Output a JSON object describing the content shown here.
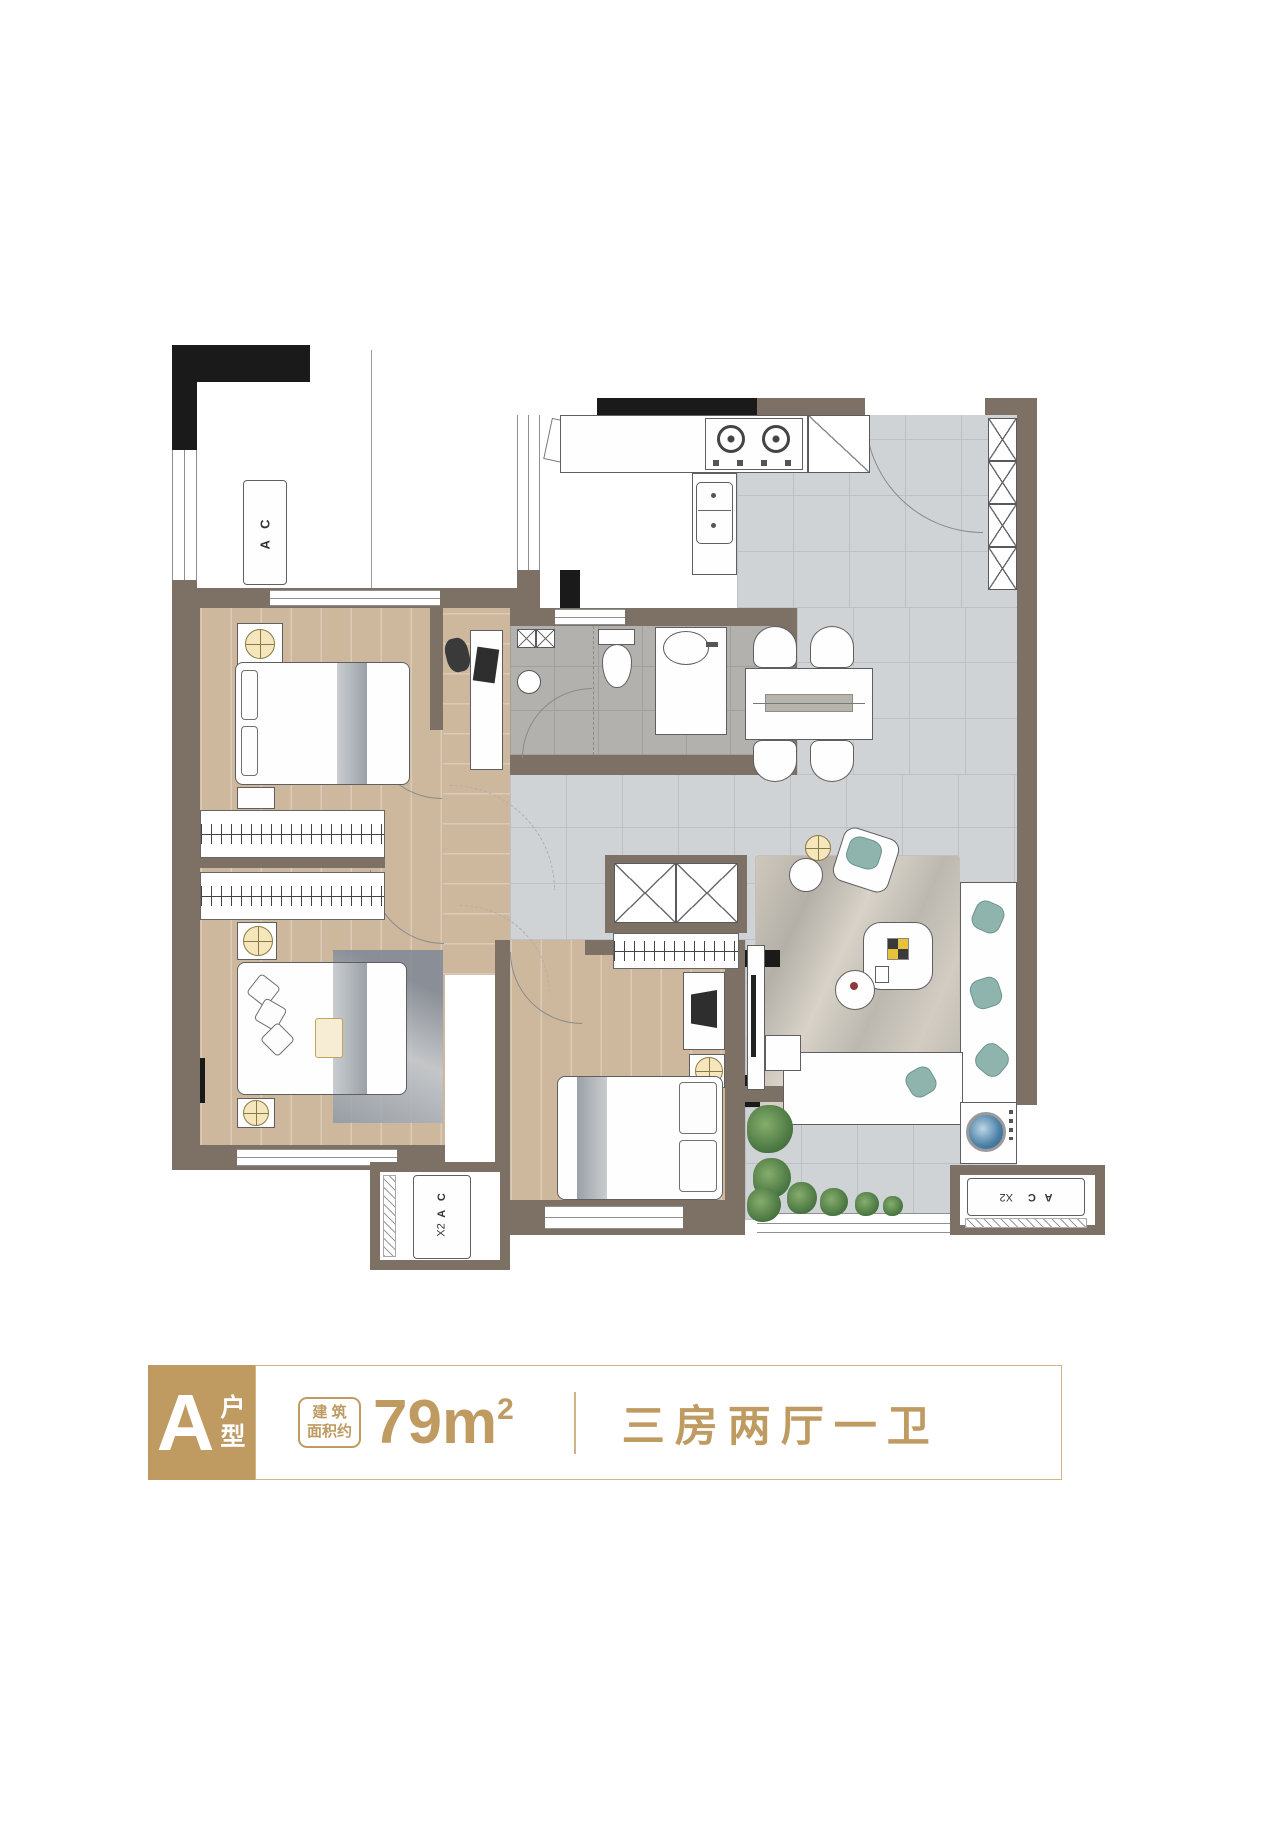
{
  "floor_plan": {
    "ac_unit_top_left": {
      "label": "A C"
    },
    "ac_platform_bottom_left": {
      "label": "A C",
      "count": "X2"
    },
    "ac_platform_bottom_right": {
      "label": "A C",
      "count": "X2"
    }
  },
  "legend": {
    "unit_letter": "A",
    "unit_suffix": "户型",
    "area_label_line1": "建 筑",
    "area_label_line2": "面积约",
    "area_value": "79m",
    "area_exponent": "2",
    "layout": "三房两厅一卫"
  },
  "colors": {
    "gold_accent": "#bf9b62",
    "wall_dark": "#1a1a1a",
    "wall_brown": "#7c7164",
    "wood_floor": "#cdb89e",
    "tile_floor": "#d0d3d6",
    "bath_tile": "#b2b1ad"
  }
}
